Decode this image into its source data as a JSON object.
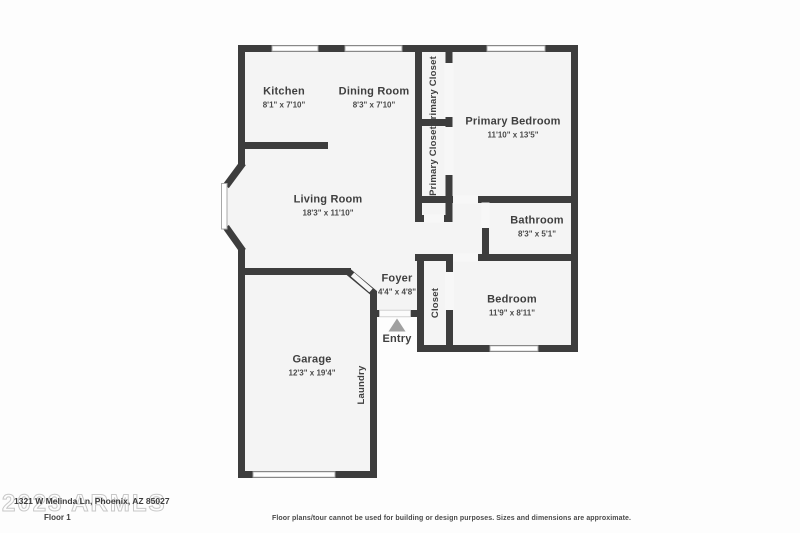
{
  "meta": {
    "address": "1321 W Melinda Ln, Phoenix, AZ 85027",
    "floor_label": "Floor 1",
    "watermark": "2023 ARMLS",
    "disclaimer": "Floor plans/tour cannot be used for building or design purposes. Sizes and dimensions are approximate."
  },
  "colors": {
    "wall": "#3d3d3d",
    "room_fill": "#f4f4f4",
    "background": "#fdfdfd",
    "label_text": "#3f3f3f",
    "entry_arrow": "#a0a0a0",
    "window_outline": "#a8a8a8",
    "watermark": "#c3c3c3"
  },
  "rooms": [
    {
      "id": "kitchen",
      "name": "Kitchen",
      "dims": "8'1\" x 7'10\""
    },
    {
      "id": "dining-room",
      "name": "Dining Room",
      "dims": "8'3\" x 7'10\""
    },
    {
      "id": "primary-closet-1",
      "name": "Primary Closet",
      "dims": ""
    },
    {
      "id": "primary-closet-2",
      "name": "Primary Closet",
      "dims": ""
    },
    {
      "id": "primary-bedroom",
      "name": "Primary Bedroom",
      "dims": "11'10\" x 13'5\""
    },
    {
      "id": "living-room",
      "name": "Living Room",
      "dims": "18'3\" x 11'10\""
    },
    {
      "id": "bathroom",
      "name": "Bathroom",
      "dims": "8'3\" x 5'1\""
    },
    {
      "id": "foyer",
      "name": "Foyer",
      "dims": "4'4\" x 4'8\""
    },
    {
      "id": "closet",
      "name": "Closet",
      "dims": ""
    },
    {
      "id": "bedroom",
      "name": "Bedroom",
      "dims": "11'9\" x 8'11\""
    },
    {
      "id": "garage",
      "name": "Garage",
      "dims": "12'3\" x 19'4\""
    },
    {
      "id": "laundry",
      "name": "Laundry",
      "dims": ""
    },
    {
      "id": "entry",
      "name": "Entry",
      "dims": ""
    }
  ]
}
